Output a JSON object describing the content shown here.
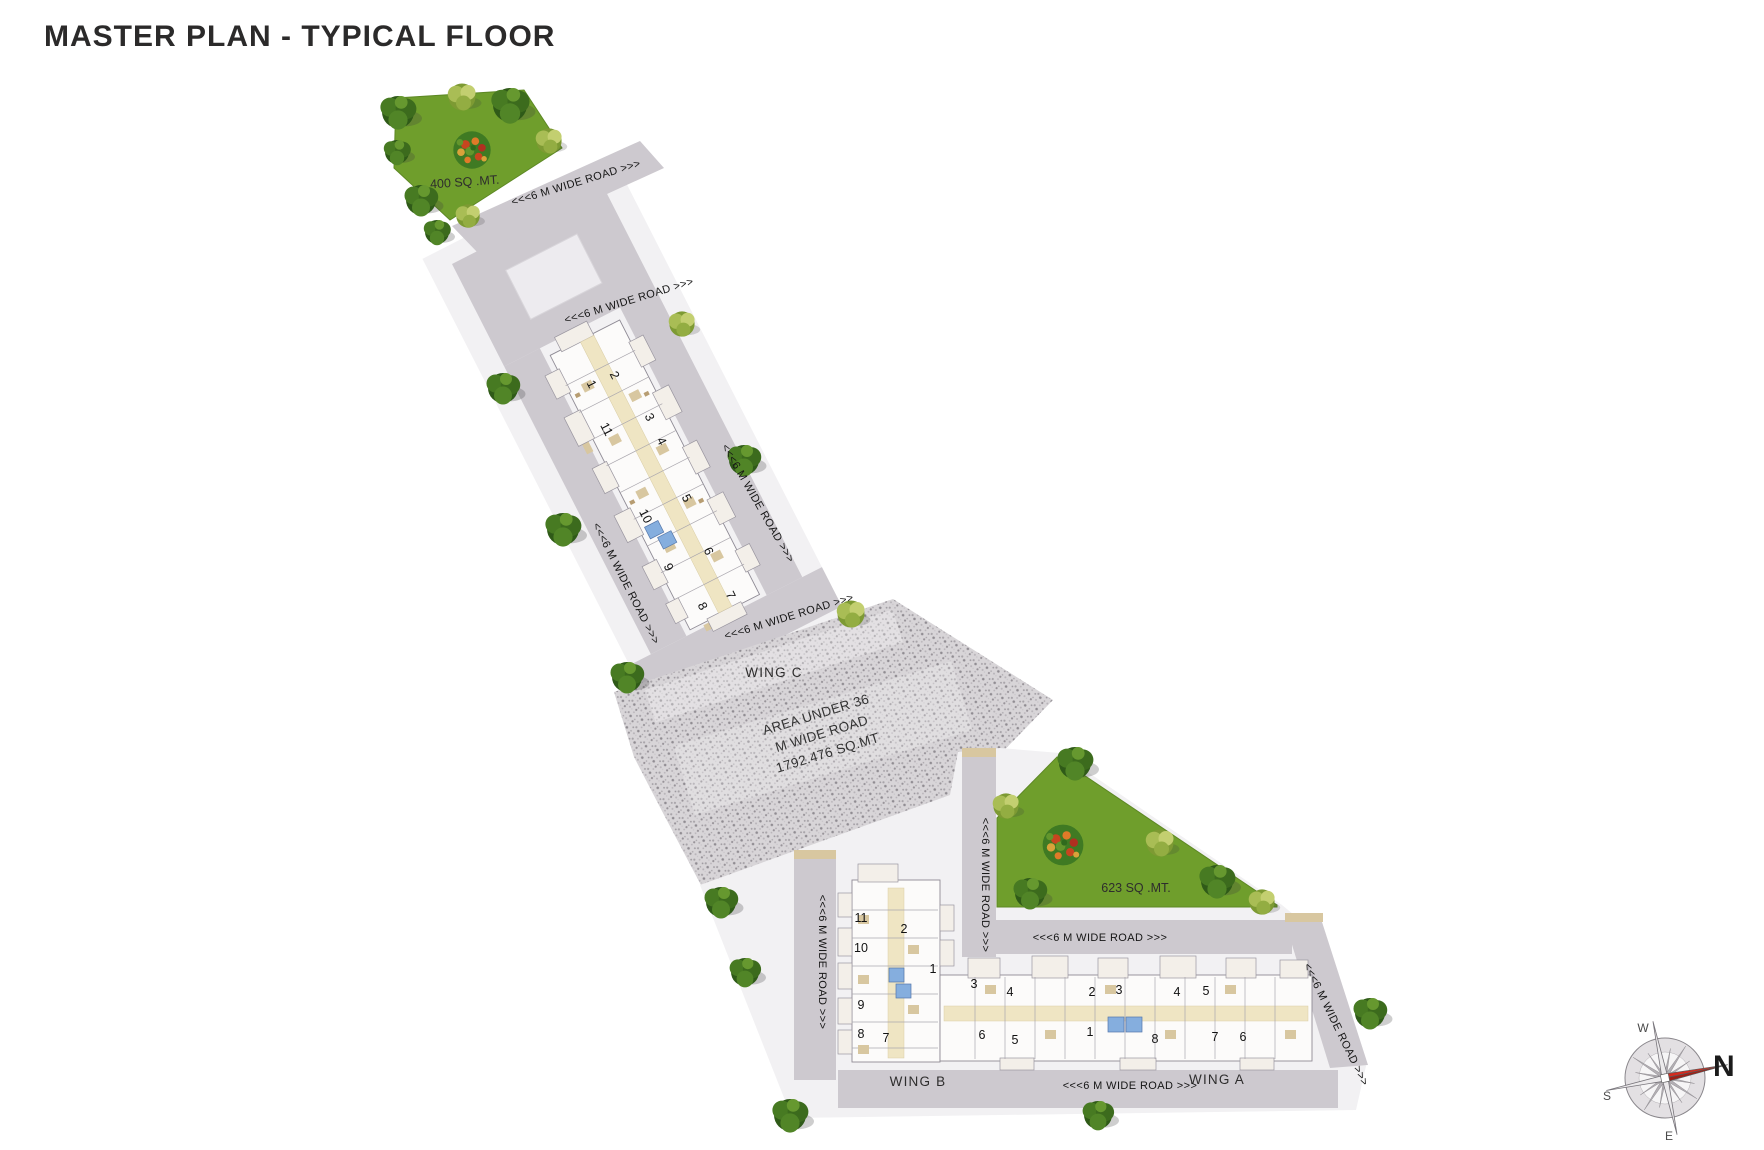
{
  "title": "MASTER PLAN - TYPICAL FLOOR",
  "plan": {
    "road_label_text": "<<<6 M WIDE ROAD >>>",
    "road_labels": [
      {
        "text": "<<<6 M WIDE ROAD >>>",
        "x": 577,
        "y": 186,
        "r": -17
      },
      {
        "text": "<<<6 M WIDE ROAD >>>",
        "x": 630,
        "y": 304,
        "r": -17
      },
      {
        "text": "<<<6 M WIDE ROAD >>>",
        "x": 755,
        "y": 505,
        "r": 60
      },
      {
        "text": "<<<6 M WIDE ROAD >>>",
        "x": 623,
        "y": 585,
        "r": 63
      },
      {
        "text": "<<<6 M WIDE ROAD >>>",
        "x": 790,
        "y": 620,
        "r": -17
      },
      {
        "text": "<<<6 M WIDE ROAD >>>",
        "x": 982,
        "y": 885,
        "r": 90
      },
      {
        "text": "<<<6 M WIDE ROAD >>>",
        "x": 1100,
        "y": 941,
        "r": 0
      },
      {
        "text": "<<<6 M WIDE ROAD >>>",
        "x": 819,
        "y": 962,
        "r": 90
      },
      {
        "text": "<<<6 M WIDE ROAD >>>",
        "x": 1130,
        "y": 1089,
        "r": 0
      },
      {
        "text": "<<<6 M WIDE ROAD >>>",
        "x": 1333,
        "y": 1026,
        "r": 64
      }
    ],
    "gardens": [
      {
        "id": "north-garden",
        "label": "400 SQ .MT."
      },
      {
        "id": "east-garden",
        "label": "623 SQ .MT."
      }
    ],
    "area_note": {
      "lines": [
        "AREA UNDER 36",
        "M WIDE ROAD",
        "1792.476 SQ.MT"
      ]
    },
    "wings": {
      "c": {
        "name": "WING C",
        "unit_rotation": 63,
        "units": [
          {
            "label": "1",
            "x": 588,
            "y": 386
          },
          {
            "label": "2",
            "x": 611,
            "y": 377
          },
          {
            "label": "3",
            "x": 646,
            "y": 419
          },
          {
            "label": "4",
            "x": 658,
            "y": 443
          },
          {
            "label": "5",
            "x": 683,
            "y": 500
          },
          {
            "label": "6",
            "x": 705,
            "y": 553
          },
          {
            "label": "7",
            "x": 727,
            "y": 597
          },
          {
            "label": "8",
            "x": 699,
            "y": 608
          },
          {
            "label": "9",
            "x": 665,
            "y": 569
          },
          {
            "label": "10",
            "x": 642,
            "y": 518
          },
          {
            "label": "11",
            "x": 603,
            "y": 431
          }
        ]
      },
      "b": {
        "name": "WING B",
        "unit_rotation": 0,
        "units": [
          {
            "label": "11",
            "x": 861,
            "y": 922
          },
          {
            "label": "2",
            "x": 904,
            "y": 933
          },
          {
            "label": "10",
            "x": 861,
            "y": 952
          },
          {
            "label": "1",
            "x": 933,
            "y": 973
          },
          {
            "label": "9",
            "x": 861,
            "y": 1009
          },
          {
            "label": "8",
            "x": 861,
            "y": 1038
          },
          {
            "label": "7",
            "x": 886,
            "y": 1042
          }
        ]
      },
      "a": {
        "name": "WING A",
        "unit_rotation": 0,
        "units": [
          {
            "label": "3",
            "x": 974,
            "y": 988
          },
          {
            "label": "4",
            "x": 1010,
            "y": 996
          },
          {
            "label": "2",
            "x": 1092,
            "y": 996
          },
          {
            "label": "3",
            "x": 1119,
            "y": 994
          },
          {
            "label": "4",
            "x": 1177,
            "y": 996
          },
          {
            "label": "5",
            "x": 1206,
            "y": 995
          },
          {
            "label": "6",
            "x": 982,
            "y": 1039
          },
          {
            "label": "5",
            "x": 1015,
            "y": 1044
          },
          {
            "label": "1",
            "x": 1090,
            "y": 1036
          },
          {
            "label": "8",
            "x": 1155,
            "y": 1043
          },
          {
            "label": "7",
            "x": 1215,
            "y": 1041
          },
          {
            "label": "6",
            "x": 1243,
            "y": 1041
          }
        ]
      }
    },
    "compass": {
      "north": "N",
      "south": "S",
      "east": "E",
      "west": "W"
    },
    "colors": {
      "road_gray": "#cdc9cf",
      "sidewalk": "#f2f1f3",
      "garden_green": "#6f9e2c",
      "corridor_cream": "#efe5c3",
      "lift_blue": "#85aede",
      "hatch_gray": "#d8d5d8",
      "compass_red": "#d42b1f",
      "title_text": "#2b2a2a"
    }
  }
}
